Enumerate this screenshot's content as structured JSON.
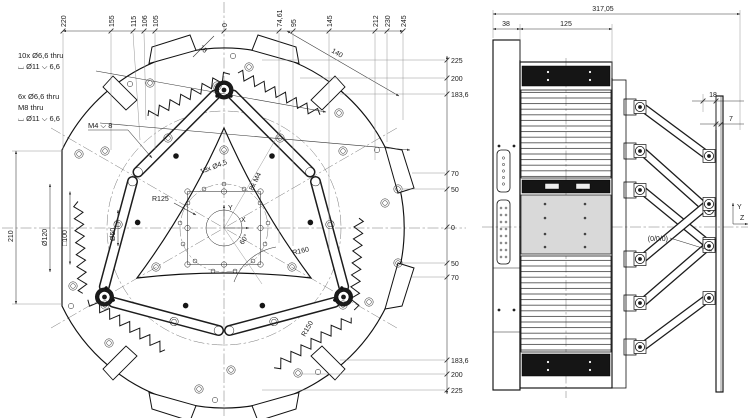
{
  "fv": {
    "callout1": [
      "10x  Ø6,6 thru",
      "⌴ Ø11 ⌵ 6,6"
    ],
    "callout2": [
      "6x  Ø6,6 thru",
      "M8 thru",
      "⌴ Ø11 ⌵ 6,6"
    ],
    "callout3": "M4 ⌵ 8",
    "top": [
      "220",
      "155",
      "115",
      "106",
      "105",
      "0",
      "74,61",
      "95",
      "145",
      "212",
      "230",
      "245"
    ],
    "right": [
      "225",
      "200",
      "183,6",
      "70",
      "50",
      "0",
      "50",
      "70",
      "183,6",
      "200",
      "225"
    ],
    "left": [
      "210",
      "Ø120",
      "□100",
      "Ø50"
    ],
    "r125": "R125",
    "r160": "R160",
    "r150": "R150",
    "d140": "140",
    "d18": "18",
    "a60": "60°",
    "h13": "13x  Ø4,5",
    "h8": "8x M4",
    "ax": "X",
    "ay": "Y"
  },
  "sv": {
    "total": "317,05",
    "w38": "38",
    "w125": "125",
    "d18": "18",
    "d7": "7",
    "origin": "(0/0/0)",
    "ay": "Y",
    "az": "Z"
  },
  "colors": {
    "line": "#111111",
    "fill_dark": "#151515",
    "fill_gray": "#d9d9d9",
    "background": "#ffffff"
  }
}
